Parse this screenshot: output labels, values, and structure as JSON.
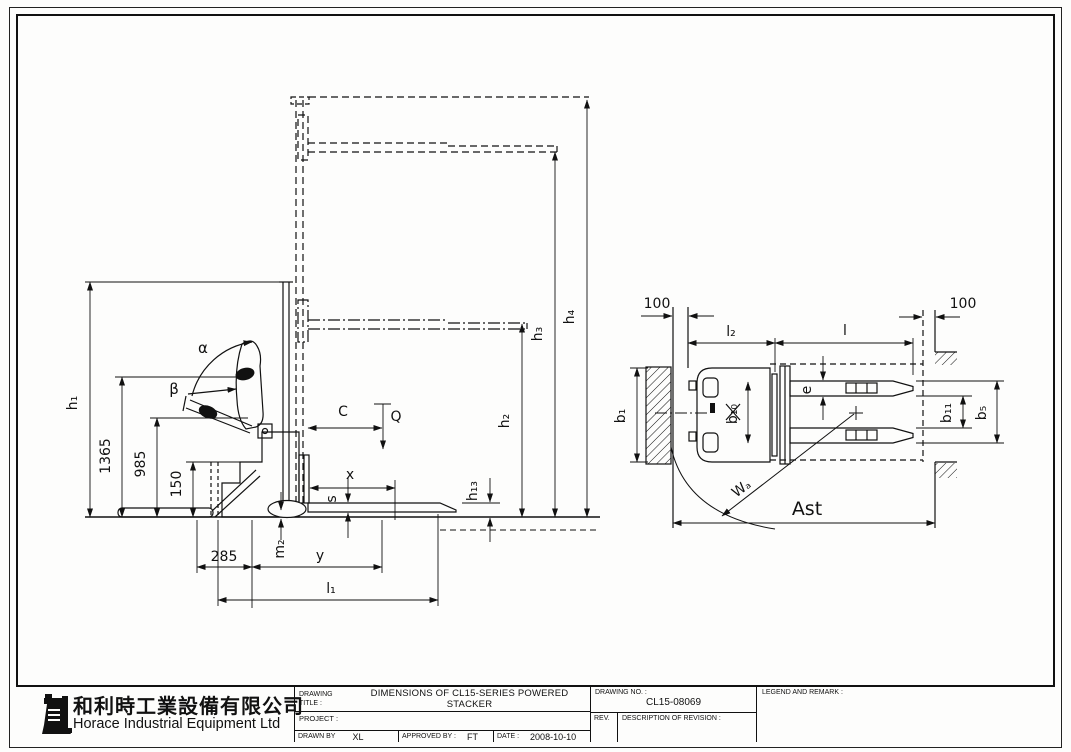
{
  "company": {
    "name_cn": "和利時工業設備有限公司",
    "name_en": "Horace Industrial Equipment Ltd"
  },
  "title_block": {
    "drawing_label_line1": "DRAWING",
    "drawing_label_line2": "TITLE :",
    "drawing_title": "DIMENSIONS OF CL15-SERIES POWERED STACKER",
    "project_label": "PROJECT :",
    "drawn_by_label": "DRAWN BY",
    "drawn_by_value": "XL",
    "approved_by_label": "APPROVED BY :",
    "approved_by_value": "FT",
    "date_label": "DATE :",
    "date_value": "2008-10-10",
    "drawing_no_label": "DRAWING NO. :",
    "drawing_no_value": "CL15-08069",
    "rev_label": "REV.",
    "revision_label": "DESCRIPTION OF REVISION :",
    "legend_label": "LEGEND AND REMARK :"
  },
  "side_view": {
    "labels": {
      "h1": "h₁",
      "d1365": "1365",
      "d985": "985",
      "d150": "150",
      "alpha": "α",
      "beta": "β",
      "c": "C",
      "q": "Q",
      "x": "x",
      "s": "s",
      "m2": "m₂",
      "d285": "285",
      "y": "y",
      "l1": "l₁",
      "h13": "h₁₃",
      "h2": "h₂",
      "h3": "h₃",
      "h4": "h₄"
    }
  },
  "top_view": {
    "labels": {
      "left_100": "100",
      "right_100": "100",
      "l2": "l₂",
      "l": "l",
      "e": "e",
      "b1": "b₁",
      "b10": "b₁₀",
      "b11": "b₁₁",
      "b5": "b₅",
      "wa": "Wₐ",
      "ast": "Ast"
    }
  }
}
